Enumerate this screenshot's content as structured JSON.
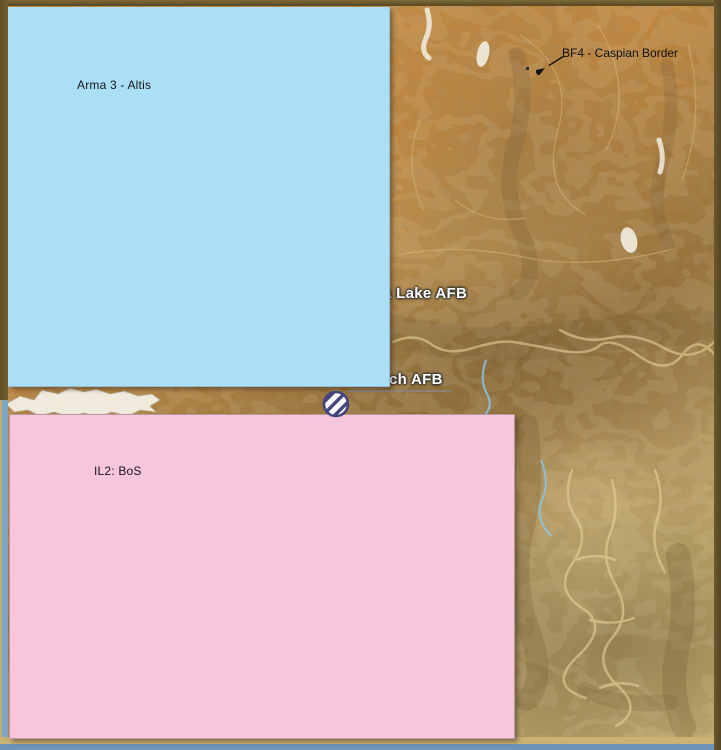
{
  "comparison": {
    "arma3": {
      "label": "Arma 3 - Altis",
      "fill": "#abdff8"
    },
    "il2": {
      "label": "IL2: BoS",
      "fill": "#f8c6da"
    },
    "bf4": {
      "label": "BF4 - Caspian Border",
      "marker": "hatched-circle"
    }
  },
  "map": {
    "labels": {
      "airbase_1": "a Lake AFB",
      "airbase_2": "ch AFB"
    },
    "colors": {
      "terrain_orange": "#c58c44",
      "terrain_brown": "#97723c",
      "terrain_khaki": "#c0a96b",
      "valley_cream": "#e4ce8e",
      "dry_lake_white": "#f2eee1",
      "stream_blue": "#86c8ee",
      "frame_dark_olive": "#5d4d26",
      "frame_bottom_tan": "#c9b273",
      "frame_bottom_blue": "#6e94b8",
      "marker_indigo": "#45457e"
    }
  }
}
